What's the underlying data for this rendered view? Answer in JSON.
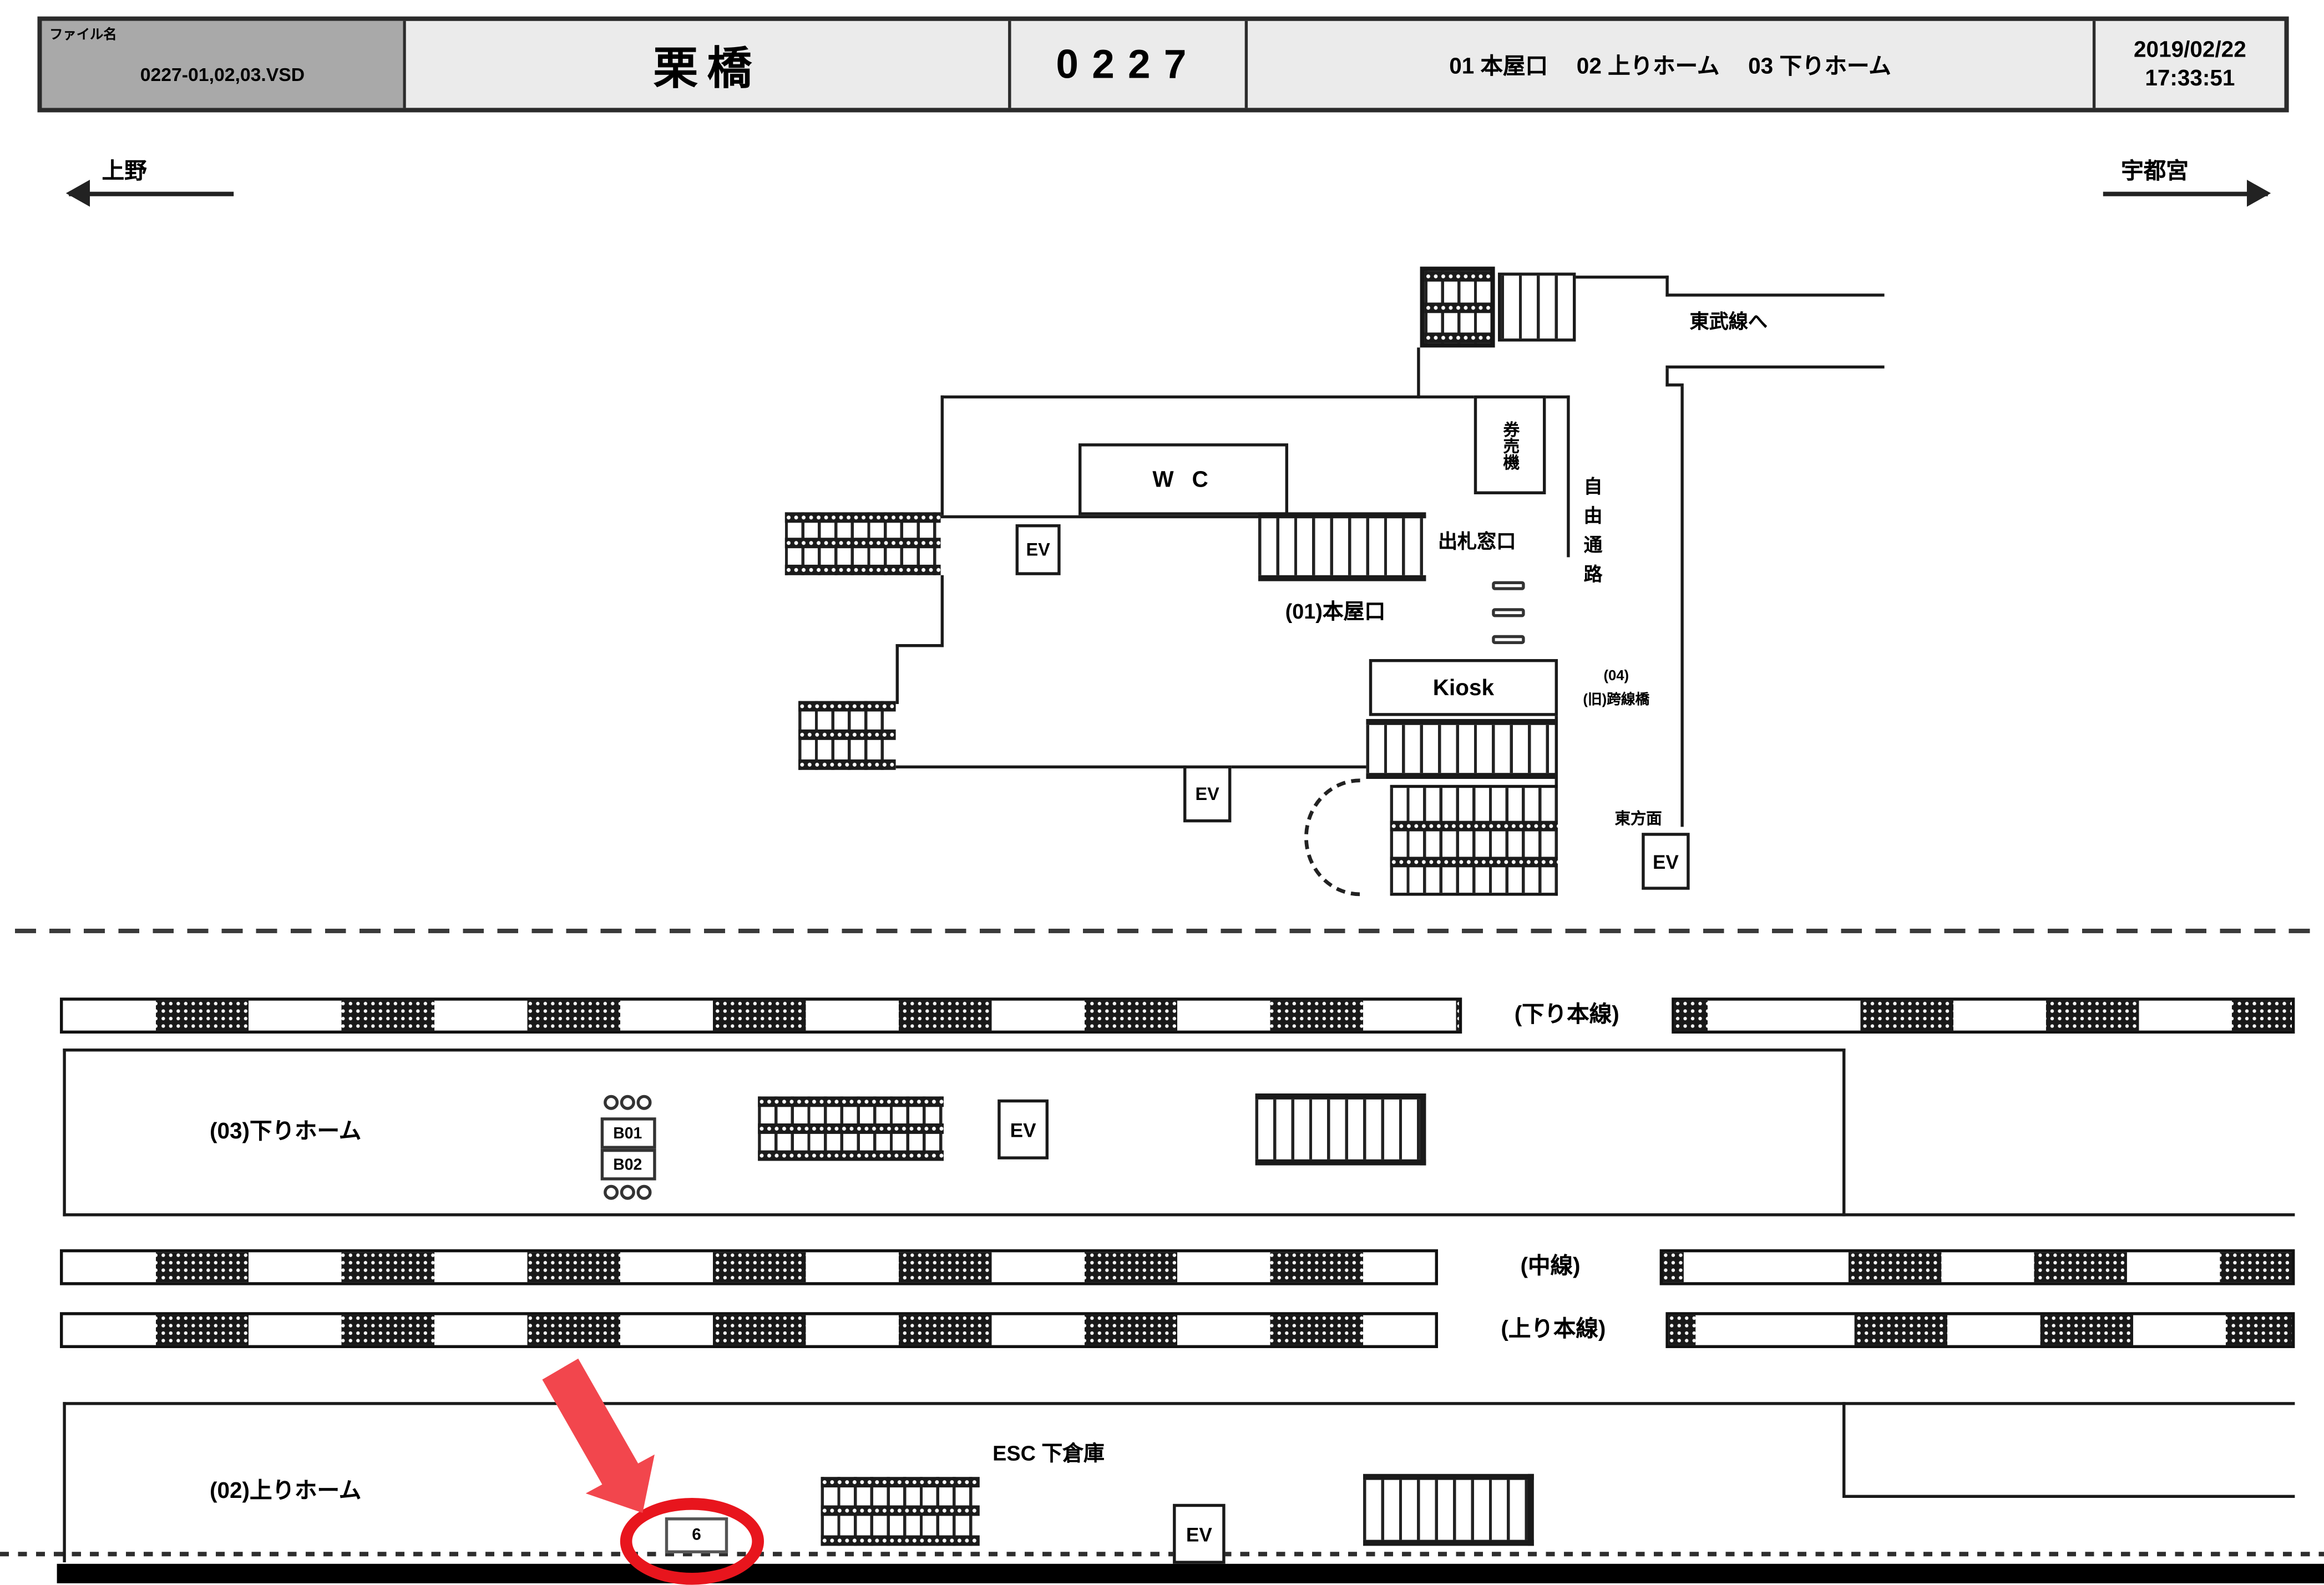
{
  "header": {
    "file_label": "ファイル名",
    "file_name": "0227-01,02,03.VSD",
    "station_name": "栗橋",
    "station_code": "0227",
    "sections": "01 本屋口　 02 上りホーム　 03 下りホーム",
    "date": "2019/02/22",
    "time": "17:33:51"
  },
  "directions": {
    "left": "上野",
    "right": "宇都宮"
  },
  "labels": {
    "ev": "EV"
  },
  "concourse": {
    "tobu_line": "東武線へ",
    "wc": "W C",
    "ticket_window": "出札窓口",
    "ticket_machine": "券売機",
    "free_passage": "自由通路",
    "overpass_number": "(04)",
    "overpass_name": "(旧)跨線橋",
    "main_entrance": "(01)本屋口",
    "kiosk": "Kiosk",
    "east_direction": "東方面"
  },
  "platforms": {
    "down_main_line": "(下り本線)",
    "down_platform": "(03)下りホーム",
    "sign_b01": "B01",
    "sign_b02": "B02",
    "middle_line": "(中線)",
    "up_main_line": "(上り本線)",
    "up_platform": "(02)上りホーム",
    "esc_storage": "ESC 下倉庫",
    "highlighted_position": "6"
  },
  "colors": {
    "highlight_red": "#e8151d",
    "arrow_red": "#f2464d",
    "header_gray": "#a9a9a9",
    "header_light": "#ebebeb",
    "line_color": "#1a1a1a"
  }
}
